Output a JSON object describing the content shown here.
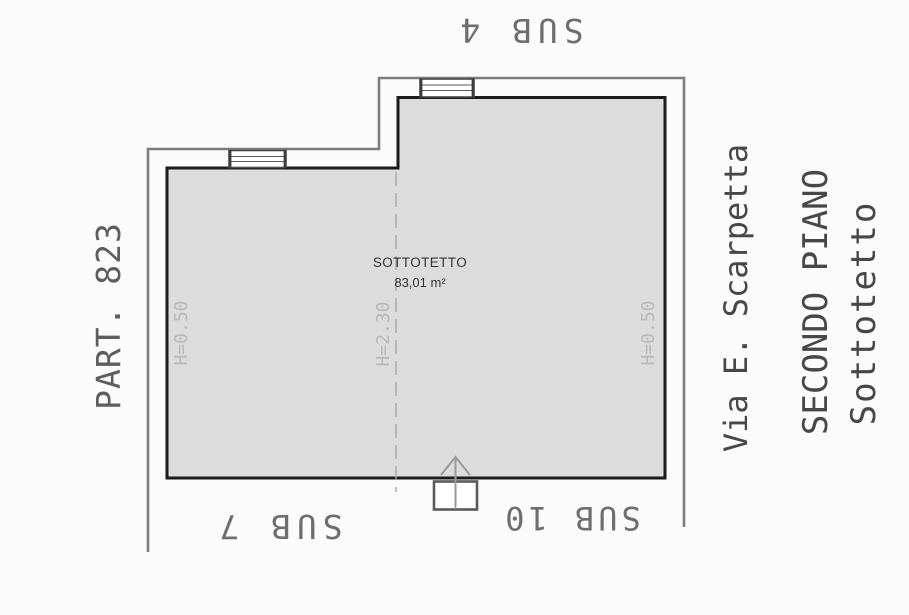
{
  "plan": {
    "room": {
      "name": "SOTTOTETTO",
      "area": "83,01 m²"
    },
    "heights": {
      "left": "H=0.50",
      "center": "H=2.30",
      "right": "H=0.50"
    },
    "subaltern_labels": {
      "top": "SUB 4",
      "bottom_left": "SUB 7",
      "bottom_right": "SUB 10"
    },
    "parcel": "PART. 823",
    "street": "Via E. Scarpetta",
    "floor": "SECONDO PIANO",
    "floor_room": "Sottotetto",
    "colors": {
      "room_fill": "#dcdcdc",
      "room_border": "#1b1b1b",
      "wall": "#7d7d7d",
      "dash_line": "#a8a8a8",
      "muted_text": "#b8b8b8",
      "cad_text": "#5e5e5e"
    }
  }
}
